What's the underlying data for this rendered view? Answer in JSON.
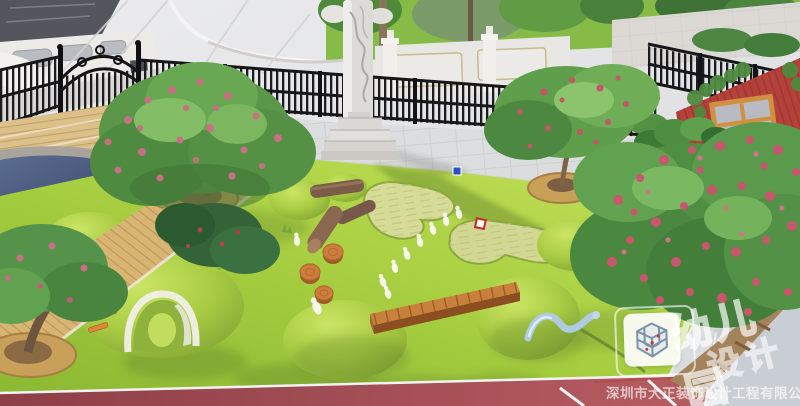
{
  "watermark": {
    "brand_line1": "幼儿园",
    "brand_line2": "设计",
    "company": "深圳市大正装饰设计工程有限公司",
    "logo": "isometric-cube-lattice-logo"
  },
  "scene": {
    "description": "aerial 3D rendering of a kindergarten outdoor playground",
    "objects": [
      "entrance-canopy",
      "ornate-iron-gate",
      "iron-fence",
      "stone-wall",
      "carved-stone-column",
      "wooden-deck",
      "pond",
      "lawn",
      "sand-pits",
      "play-mounds",
      "tunnel-mound",
      "climbing-rungs",
      "balance-beam",
      "log-obstacles",
      "wood-stumps",
      "footprint-path",
      "stepping-stones",
      "worm-sculpture",
      "tree-ring-benches",
      "flowering-trees",
      "planter-boxes",
      "red-container-house",
      "running-track"
    ]
  },
  "palette": {
    "lawn": "#a8cf41",
    "lawn_light": "#c4e05a",
    "lawn_dark": "#8cb833",
    "lawn_shadow": "#5e7f2c",
    "sand": "#d6db97",
    "wood": "#d8b472",
    "beam": "#c9803c",
    "stump": "#cd7d3c",
    "fence": "#1c1c20",
    "wall": "#e6e3de",
    "pond": "#46587a",
    "building_red": "#b4423a",
    "planter_orange": "#d28c3c",
    "track_red": "#a24b55",
    "paving": "#dcdddf",
    "foliage": "#55924a",
    "flower_pink": "#c8566c",
    "worm_blue": "#aecbe2",
    "marker_blue": "#2f4ec2",
    "marker_red": "#c8291f",
    "white": "#f2f1ee"
  }
}
